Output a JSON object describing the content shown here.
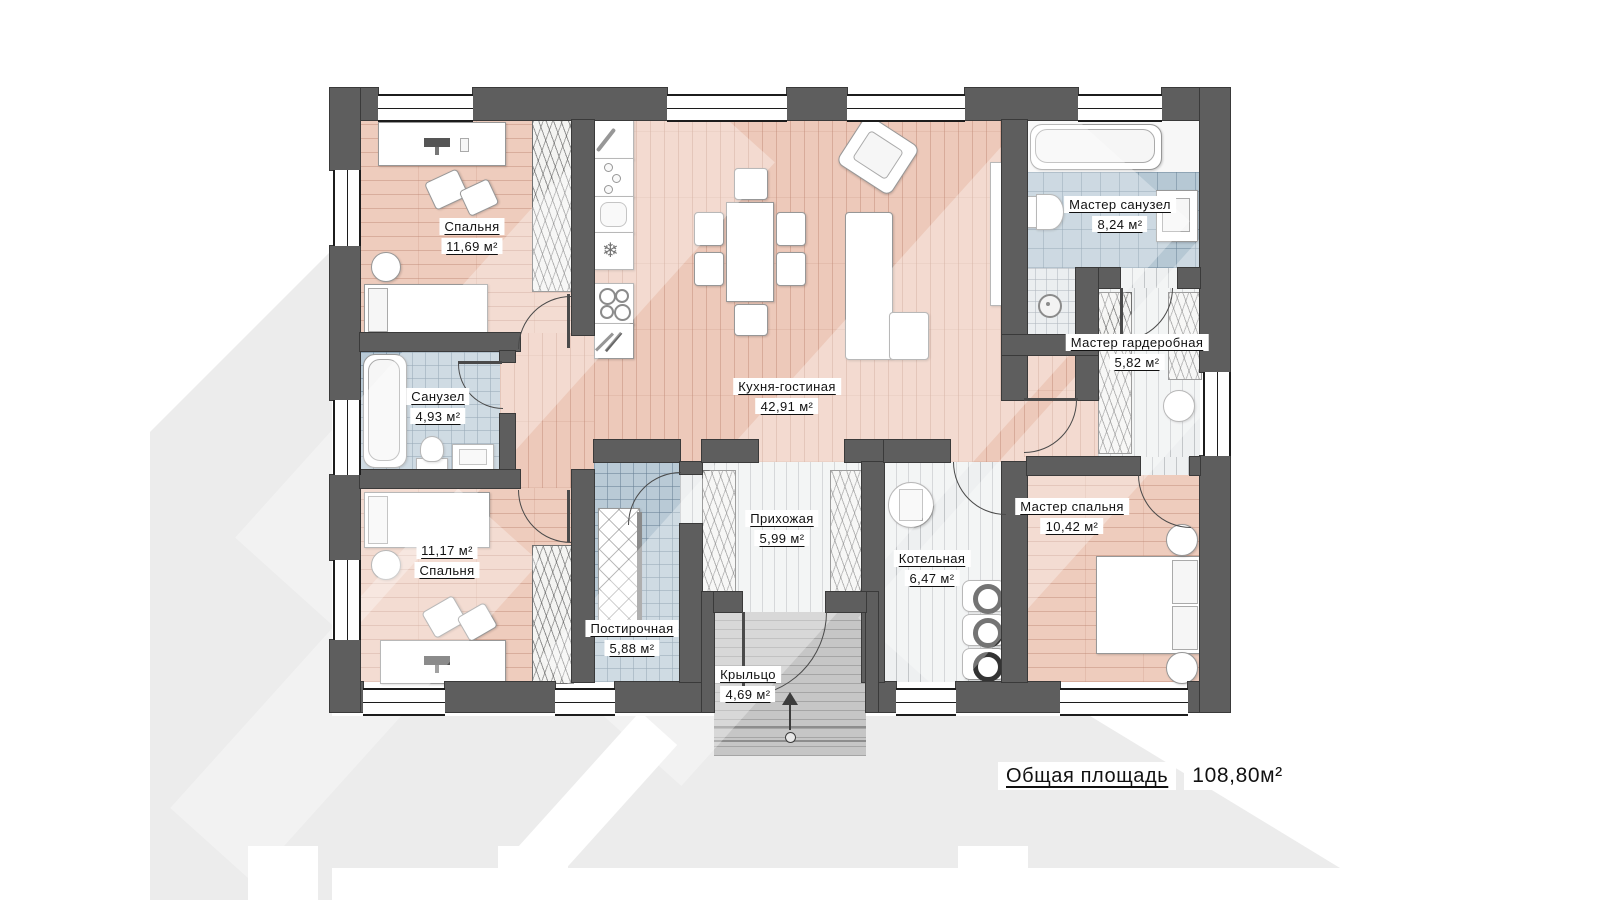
{
  "rooms": [
    {
      "id": "bedroom-1",
      "name": "Спальня",
      "area": "11,69 м²"
    },
    {
      "id": "master-bathroom",
      "name": "Мастер санузел",
      "area": "8,24 м²"
    },
    {
      "id": "kitchen-living",
      "name": "Кухня-гостиная",
      "area": "42,91 м²"
    },
    {
      "id": "bathroom",
      "name": "Санузел",
      "area": "4,93 м²"
    },
    {
      "id": "master-wardrobe",
      "name": "Мастер гардеробная",
      "area": "5,82 м²"
    },
    {
      "id": "bedroom-2",
      "name": "Спальня",
      "area": "11,17 м²"
    },
    {
      "id": "hallway",
      "name": "Прихожая",
      "area": "5,99 м²"
    },
    {
      "id": "boiler-room",
      "name": "Котельная",
      "area": "6,47 м²"
    },
    {
      "id": "master-bedroom",
      "name": "Мастер спальня",
      "area": "10,42 м²"
    },
    {
      "id": "laundry",
      "name": "Постирочная",
      "area": "5,88 м²"
    },
    {
      "id": "porch",
      "name": "Крыльцо",
      "area": "4,69 м²"
    }
  ],
  "total": {
    "label": "Общая площадь",
    "value": "108,80м²"
  },
  "icons": {
    "fridge": "❄"
  },
  "colors": {
    "wall": "#5e5e5e",
    "wood": "#edc9ba",
    "tile": "#b9cad6",
    "shadow": "#ececec"
  }
}
